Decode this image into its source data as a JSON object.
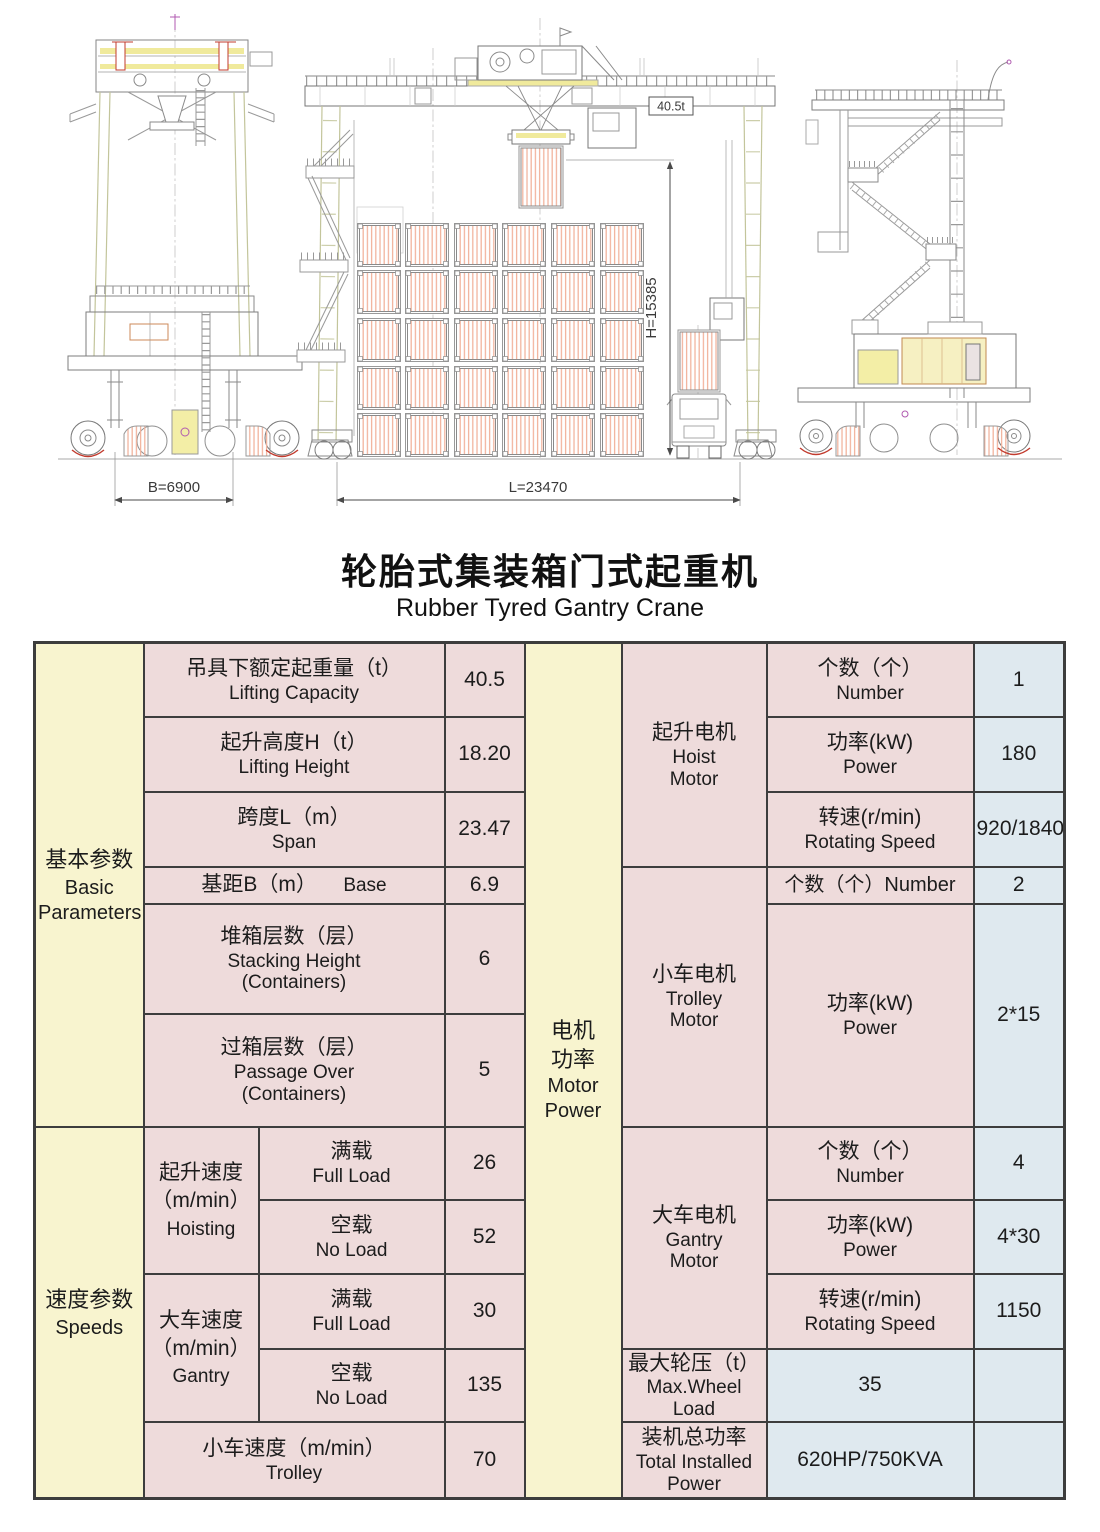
{
  "title": {
    "zh": "轮胎式集装箱门式起重机",
    "en": "Rubber Tyred Gantry Crane"
  },
  "drawing": {
    "dim_b": "B=6900",
    "dim_l": "L=23470",
    "dim_h": "H=15385",
    "load_label": "40.5t"
  },
  "colors": {
    "group_bg": "#f8f4cf",
    "label_bg": "#eedbdb",
    "value_bg": "#dfe9ef",
    "border": "#3d3d3d",
    "container_hatch": "#f2b49e"
  },
  "table": {
    "groups": {
      "basic": {
        "zh": "基本参数",
        "en1": "Basic",
        "en2": "Parameters"
      },
      "speeds": {
        "zh": "速度参数",
        "en": "Speeds"
      },
      "motor_power": {
        "zh1": "电机",
        "zh2": "功率",
        "en1": "Motor",
        "en2": "Power"
      }
    },
    "basic_rows": {
      "lifting_capacity": {
        "zh": "吊具下额定起重量（t）",
        "en": "Lifting Capacity",
        "value": "40.5"
      },
      "lifting_height": {
        "zh": "起升高度H（t）",
        "en": "Lifting Height",
        "value": "18.20"
      },
      "span": {
        "zh": "跨度L（m）",
        "en": "Span",
        "value": "23.47"
      },
      "base": {
        "zh": "基距B（m）",
        "en": "Base",
        "value": "6.9"
      },
      "stacking": {
        "zh": "堆箱层数（层）",
        "en1": "Stacking Height",
        "en2": "(Containers)",
        "value": "6"
      },
      "passage": {
        "zh": "过箱层数（层）",
        "en1": "Passage Over",
        "en2": "(Containers)",
        "value": "5"
      }
    },
    "speed_rows": {
      "hoisting": {
        "zh": "起升速度",
        "unit": "（m/min）",
        "en": "Hoisting",
        "full": {
          "zh": "满载",
          "en": "Full Load",
          "value": "26"
        },
        "empty": {
          "zh": "空载",
          "en": "No Load",
          "value": "52"
        }
      },
      "gantry": {
        "zh": "大车速度",
        "unit": "（m/min）",
        "en": "Gantry",
        "full": {
          "zh": "满载",
          "en": "Full Load",
          "value": "30"
        },
        "empty": {
          "zh": "空载",
          "en": "No Load",
          "value": "135"
        }
      },
      "trolley": {
        "zh": "小车速度（m/min）",
        "en": "Trolley",
        "value": "70"
      }
    },
    "motors": {
      "hoist": {
        "zh": "起升电机",
        "en1": "Hoist",
        "en2": "Motor",
        "number": {
          "zh": "个数（个）",
          "en": "Number",
          "value": "1"
        },
        "power": {
          "zh": "功率(kW)",
          "en": "Power",
          "value": "180"
        },
        "speed": {
          "zh": "转速(r/min)",
          "en": "Rotating Speed",
          "value": "920/1840"
        }
      },
      "trolley": {
        "zh": "小车电机",
        "en1": "Trolley",
        "en2": "Motor",
        "number": {
          "zh": "个数（个）Number",
          "value": "2"
        },
        "power": {
          "zh": "功率(kW)",
          "en": "Power",
          "value": "2*15"
        }
      },
      "gantry": {
        "zh": "大车电机",
        "en1": "Gantry",
        "en2": "Motor",
        "number": {
          "zh": "个数（个）",
          "en": "Number",
          "value": "4"
        },
        "power": {
          "zh": "功率(kW)",
          "en": "Power",
          "value": "4*30"
        },
        "speed": {
          "zh": "转速(r/min)",
          "en": "Rotating Speed",
          "value": "1150"
        }
      }
    },
    "extras": {
      "max_wheel": {
        "zh": "最大轮压（t）",
        "en1": "Max.Wheel",
        "en2": "Load",
        "value": "35"
      },
      "total_power": {
        "zh": "装机总功率",
        "en1": "Total Installed",
        "en2": "Power",
        "value": "620HP/750KVA"
      }
    }
  }
}
